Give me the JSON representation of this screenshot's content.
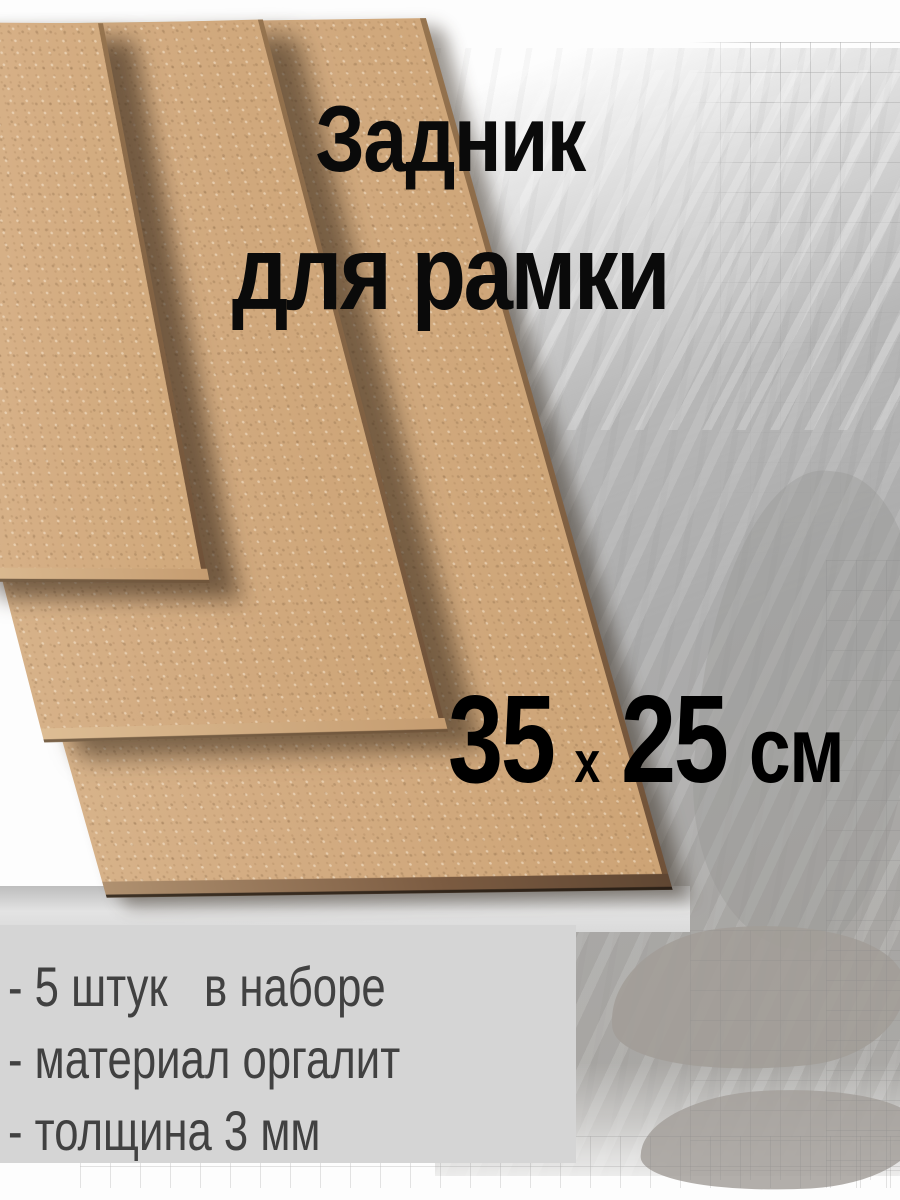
{
  "overlay": {
    "title_line1": "Задник",
    "title_line2": "для рамки",
    "size_label": {
      "width_value": "35",
      "separator": "x",
      "height_value": "25",
      "unit": "см"
    }
  },
  "info_panel": {
    "features": [
      "- 5 штук   в наборе",
      "- материал оргалит",
      "- толщина 3 мм"
    ]
  },
  "scene": {
    "subject": "stack of three hardboard frame-backing sheets on painted paper background",
    "colors": {
      "board_face": "#d3ac82",
      "board_edge_dark": "#5f4632",
      "board_edge_light": "#ddbd94",
      "background_wash_gray": "#ababab",
      "graph_paper_line": "#878787",
      "info_panel_bg": "#d5d5d5",
      "title_text": "#0a0a0a",
      "feature_text": "#414141"
    }
  }
}
